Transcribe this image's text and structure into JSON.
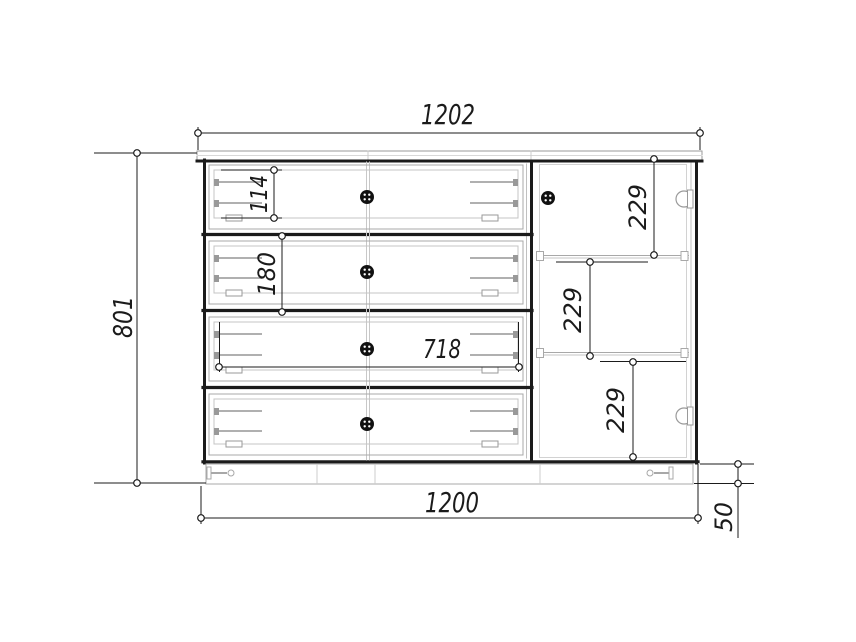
{
  "drawing": {
    "background": "#ffffff",
    "line_color": "#1b1b1b",
    "detail_color": "#b0b0b0",
    "dimensions": {
      "top_width": "1202",
      "left_height": "801",
      "drawer1_inner_height": "114",
      "drawer2_front_height": "180",
      "drawer_inner_width": "718",
      "door_section_top": "229",
      "door_section_middle": "229",
      "door_section_bottom": "229",
      "bottom_width": "1200",
      "plinth_height": "50"
    }
  }
}
